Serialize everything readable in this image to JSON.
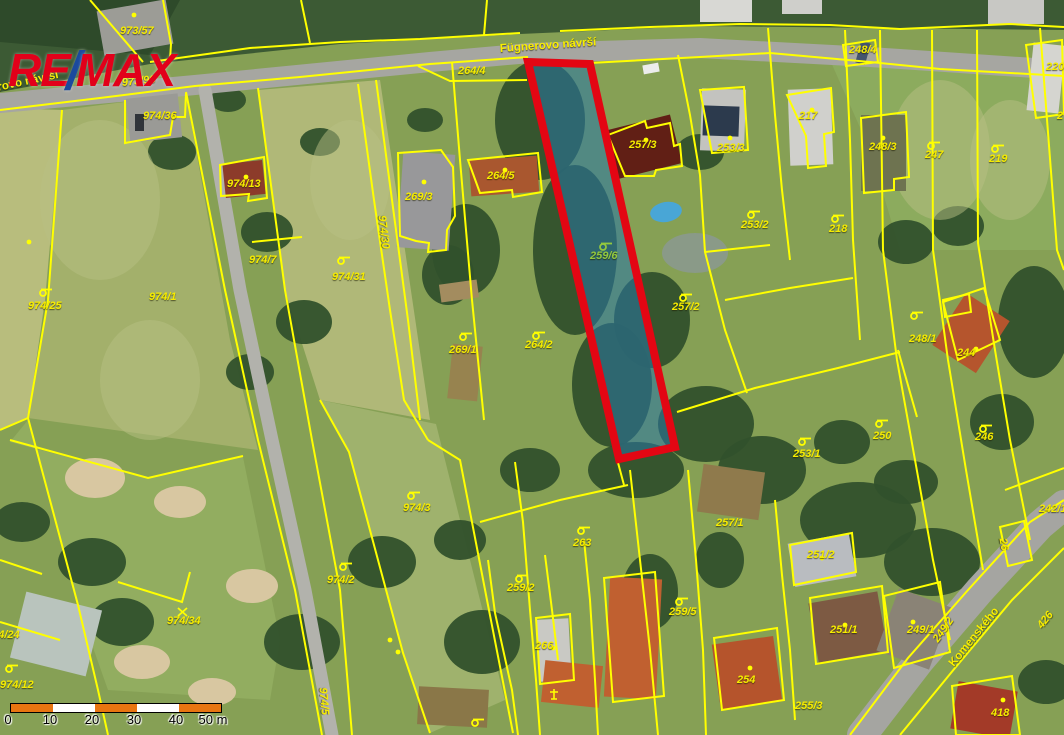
{
  "logo": {
    "re": "RE",
    "slash": "/",
    "max": "MAX",
    "red": "#e2001a",
    "blue": "#1b4a9e"
  },
  "highlight": {
    "label": "259/6",
    "points": "528,62 590,64 675,447 619,459",
    "fill": "#2877a8",
    "fill_opacity": 0.55,
    "stroke": "#e30613",
    "stroke_width": 8
  },
  "street_labels": [
    {
      "t": "Fügnerovo návrší",
      "x": -36,
      "y": 90,
      "r": -12
    },
    {
      "t": "Fügnerovo návrší",
      "x": 500,
      "y": 44,
      "r": -4
    },
    {
      "t": "Komenského",
      "x": 952,
      "y": 660,
      "r": -51
    }
  ],
  "parcel_labels": [
    {
      "t": "973/57",
      "x": 120,
      "y": 26
    },
    {
      "t": "973/96",
      "x": 122,
      "y": 78,
      "r": -6
    },
    {
      "t": "264/4",
      "x": 458,
      "y": 66
    },
    {
      "t": "974/36",
      "x": 143,
      "y": 111
    },
    {
      "t": "974/13",
      "x": 227,
      "y": 179
    },
    {
      "t": "974/7",
      "x": 249,
      "y": 255
    },
    {
      "t": "974/25",
      "x": 28,
      "y": 301
    },
    {
      "t": "974/1",
      "x": 149,
      "y": 292
    },
    {
      "t": "974/31",
      "x": 332,
      "y": 272
    },
    {
      "t": "974/30",
      "x": 381,
      "y": 210,
      "r": 83
    },
    {
      "t": "269/3",
      "x": 405,
      "y": 192
    },
    {
      "t": "264/5",
      "x": 487,
      "y": 171
    },
    {
      "t": "269/1",
      "x": 449,
      "y": 345
    },
    {
      "t": "264/2",
      "x": 525,
      "y": 340
    },
    {
      "t": "259/6",
      "x": 590,
      "y": 251,
      "c": "#93c83e"
    },
    {
      "t": "257/2",
      "x": 672,
      "y": 302
    },
    {
      "t": "257/3",
      "x": 629,
      "y": 140
    },
    {
      "t": "253/3",
      "x": 717,
      "y": 143
    },
    {
      "t": "217",
      "x": 799,
      "y": 111
    },
    {
      "t": "253/2",
      "x": 741,
      "y": 220
    },
    {
      "t": "218",
      "x": 829,
      "y": 224
    },
    {
      "t": "248/4",
      "x": 849,
      "y": 45
    },
    {
      "t": "248/3",
      "x": 869,
      "y": 142
    },
    {
      "t": "247",
      "x": 925,
      "y": 150
    },
    {
      "t": "219",
      "x": 989,
      "y": 154
    },
    {
      "t": "220",
      "x": 1046,
      "y": 62
    },
    {
      "t": "2",
      "x": 1057,
      "y": 111
    },
    {
      "t": "248/1",
      "x": 909,
      "y": 334
    },
    {
      "t": "244",
      "x": 957,
      "y": 348
    },
    {
      "t": "250",
      "x": 873,
      "y": 431
    },
    {
      "t": "246",
      "x": 975,
      "y": 432
    },
    {
      "t": "253/1",
      "x": 793,
      "y": 449
    },
    {
      "t": "974/3",
      "x": 403,
      "y": 503
    },
    {
      "t": "974/2",
      "x": 327,
      "y": 575
    },
    {
      "t": "263",
      "x": 573,
      "y": 538
    },
    {
      "t": "259/2",
      "x": 507,
      "y": 583
    },
    {
      "t": "266",
      "x": 535,
      "y": 641
    },
    {
      "t": "259/5",
      "x": 669,
      "y": 607
    },
    {
      "t": "257/1",
      "x": 716,
      "y": 518
    },
    {
      "t": "251/2",
      "x": 807,
      "y": 550
    },
    {
      "t": "251/1",
      "x": 830,
      "y": 625
    },
    {
      "t": "254",
      "x": 737,
      "y": 675
    },
    {
      "t": "255/3",
      "x": 795,
      "y": 701
    },
    {
      "t": "242/1",
      "x": 1039,
      "y": 504
    },
    {
      "t": "249/1",
      "x": 907,
      "y": 625
    },
    {
      "t": "249/2",
      "x": 936,
      "y": 636,
      "r": -55
    },
    {
      "t": "426",
      "x": 1040,
      "y": 622,
      "r": -51
    },
    {
      "t": "418",
      "x": 991,
      "y": 708
    },
    {
      "t": "974/34",
      "x": 167,
      "y": 616
    },
    {
      "t": "974/12",
      "x": 0,
      "y": 680
    },
    {
      "t": "974/24",
      "x": -14,
      "y": 630
    },
    {
      "t": "974/5",
      "x": 322,
      "y": 682,
      "r": 85
    },
    {
      "t": "26",
      "x": 1002,
      "y": 533,
      "r": 80
    }
  ],
  "symbols": [
    {
      "x": 38,
      "y": 286
    },
    {
      "x": 336,
      "y": 254
    },
    {
      "x": 458,
      "y": 330
    },
    {
      "x": 531,
      "y": 329
    },
    {
      "x": 598,
      "y": 240,
      "c": "#93c83e"
    },
    {
      "x": 678,
      "y": 291
    },
    {
      "x": 746,
      "y": 208
    },
    {
      "x": 830,
      "y": 212
    },
    {
      "x": 926,
      "y": 139
    },
    {
      "x": 990,
      "y": 142
    },
    {
      "x": 909,
      "y": 309
    },
    {
      "x": 874,
      "y": 417
    },
    {
      "x": 978,
      "y": 422
    },
    {
      "x": 797,
      "y": 435
    },
    {
      "x": 406,
      "y": 489
    },
    {
      "x": 338,
      "y": 560
    },
    {
      "x": 576,
      "y": 524
    },
    {
      "x": 514,
      "y": 572
    },
    {
      "x": 674,
      "y": 595
    },
    {
      "x": 4,
      "y": 662
    },
    {
      "x": 470,
      "y": 716
    },
    {
      "x": 176,
      "y": 606,
      "type": "x"
    },
    {
      "x": 548,
      "y": 688,
      "type": "cross"
    }
  ],
  "dots": [
    [
      134,
      15
    ],
    [
      246,
      177
    ],
    [
      424,
      182
    ],
    [
      505,
      170
    ],
    [
      646,
      140
    ],
    [
      730,
      138
    ],
    [
      812,
      110
    ],
    [
      883,
      138
    ],
    [
      976,
      349
    ],
    [
      822,
      558
    ],
    [
      845,
      625
    ],
    [
      750,
      668
    ],
    [
      553,
      648
    ],
    [
      913,
      622
    ],
    [
      1003,
      700
    ],
    [
      29,
      242
    ],
    [
      390,
      640
    ],
    [
      398,
      652
    ]
  ],
  "map": {
    "line_color": "#ffff00",
    "terrain_polys": [
      {
        "p": "0,0 1064,0 1064,30 700,26 520,34 340,44 150,64 0,92",
        "f": "#3c5a34"
      },
      {
        "p": "0,0 180,0 150,55 0,42",
        "f": "#2e4a2a"
      },
      {
        "p": "0,108 62,110 45,300 28,418 0,430",
        "f": "#b8bd7d"
      },
      {
        "p": "62,110 186,94 230,340 258,450 28,418 48,300",
        "f": "#a3b06b"
      },
      {
        "p": "258,90 380,80 430,420 320,400 285,290",
        "f": "#b0b878"
      },
      {
        "p": "320,400 436,424 470,560 505,700 430,733 403,653 349,452",
        "f": "#9fb26d"
      },
      {
        "p": "10,442 148,478 243,457 280,640 270,700 108,690 78,605 28,420",
        "f": "#92ad60"
      },
      {
        "p": "830,60 1064,80 1064,250 900,250 870,150",
        "f": "#8cab5e"
      }
    ],
    "trees": [
      [
        540,
        120,
        45,
        60
      ],
      [
        575,
        250,
        42,
        85
      ],
      [
        612,
        385,
        40,
        62
      ],
      [
        466,
        250,
        34,
        46
      ],
      [
        448,
        275,
        26,
        30
      ],
      [
        652,
        320,
        38,
        48
      ],
      [
        706,
        424,
        48,
        38
      ],
      [
        762,
        470,
        44,
        34
      ],
      [
        636,
        470,
        48,
        28
      ],
      [
        858,
        520,
        58,
        38
      ],
      [
        932,
        562,
        48,
        34
      ],
      [
        302,
        642,
        38,
        28
      ],
      [
        382,
        562,
        34,
        26
      ],
      [
        482,
        642,
        38,
        32
      ],
      [
        172,
        152,
        24,
        18
      ],
      [
        267,
        232,
        26,
        20
      ],
      [
        304,
        322,
        28,
        22
      ],
      [
        92,
        562,
        34,
        24
      ],
      [
        22,
        522,
        28,
        20
      ],
      [
        122,
        622,
        32,
        24
      ],
      [
        250,
        372,
        24,
        18
      ],
      [
        700,
        152,
        24,
        18
      ],
      [
        906,
        242,
        28,
        22
      ],
      [
        958,
        226,
        26,
        20
      ],
      [
        1034,
        322,
        36,
        56
      ],
      [
        1002,
        422,
        32,
        28
      ],
      [
        842,
        442,
        28,
        22
      ],
      [
        650,
        592,
        28,
        38
      ],
      [
        720,
        560,
        24,
        28
      ],
      [
        906,
        482,
        32,
        22
      ],
      [
        1046,
        682,
        28,
        22
      ],
      [
        320,
        142,
        20,
        14
      ],
      [
        228,
        100,
        18,
        12
      ],
      [
        425,
        120,
        18,
        12
      ],
      [
        530,
        470,
        30,
        22
      ],
      [
        460,
        540,
        26,
        20
      ]
    ],
    "light_patches": [
      [
        100,
        200,
        60,
        80
      ],
      [
        150,
        380,
        50,
        60
      ],
      [
        350,
        180,
        40,
        60
      ],
      [
        940,
        150,
        50,
        70
      ],
      [
        1010,
        160,
        40,
        60
      ]
    ],
    "sand": [
      [
        95,
        478,
        30,
        20
      ],
      [
        180,
        502,
        26,
        16
      ],
      [
        62,
        640,
        24,
        15
      ],
      [
        142,
        662,
        28,
        17
      ],
      [
        252,
        586,
        26,
        17
      ],
      [
        212,
        692,
        24,
        14
      ]
    ],
    "gray_patches": [
      [
        695,
        253,
        33,
        20
      ]
    ],
    "roads": [
      {
        "p": "0,103 195,85 430,62 530,53 700,48 870,57 1064,70",
        "w": 20,
        "f": "#a6a6a1"
      },
      {
        "p": "205,90 240,290 272,440 305,590 332,735",
        "w": 13,
        "f": "#b2b2ac"
      },
      {
        "p": "862,735 920,660 980,590 1040,525 1064,505",
        "w": 30,
        "f": "#a5a5a1"
      }
    ],
    "buildings": [
      [
        224,
        162,
        40,
        34,
        -6,
        "#8c3b2a"
      ],
      [
        400,
        153,
        52,
        96,
        4,
        "#98989a"
      ],
      [
        470,
        158,
        68,
        36,
        -4,
        "#a9572f"
      ],
      [
        609,
        122,
        68,
        50,
        -14,
        "#611f15"
      ],
      [
        701,
        89,
        44,
        62,
        2,
        "#c3c3bf"
      ],
      [
        703,
        106,
        36,
        30,
        2,
        "#2c3a4d"
      ],
      [
        789,
        89,
        43,
        76,
        -2,
        "#d0d0cc"
      ],
      [
        861,
        115,
        45,
        76,
        0,
        "#6e7350"
      ],
      [
        945,
        302,
        52,
        62,
        33,
        "#b5552d"
      ],
      [
        791,
        538,
        62,
        44,
        -10,
        "#b9bcc0"
      ],
      [
        813,
        597,
        70,
        60,
        -10,
        "#7d5a43"
      ],
      [
        716,
        640,
        62,
        66,
        -8,
        "#b5542c"
      ],
      [
        538,
        619,
        32,
        62,
        -3,
        "#c9c9c4"
      ],
      [
        607,
        578,
        52,
        120,
        3,
        "#c06030"
      ],
      [
        543,
        663,
        58,
        42,
        6,
        "#c06030"
      ],
      [
        886,
        596,
        56,
        66,
        20,
        "#8a8376"
      ],
      [
        954,
        686,
        60,
        48,
        10,
        "#a33a28"
      ],
      [
        17,
        600,
        78,
        68,
        14,
        "#b9c4bd"
      ],
      [
        100,
        5,
        70,
        45,
        -10,
        "#9c9c96"
      ],
      [
        128,
        96,
        52,
        44,
        -6,
        "#9a9a96"
      ],
      [
        1030,
        44,
        32,
        68,
        6,
        "#d5d5d0"
      ],
      [
        700,
        0,
        52,
        22,
        0,
        "#d8d8d4"
      ],
      [
        782,
        0,
        40,
        14,
        0,
        "#cfcfcb"
      ],
      [
        988,
        0,
        56,
        24,
        0,
        "#c8c8c4"
      ],
      [
        135,
        114,
        9,
        17,
        0,
        "#30343a"
      ],
      [
        858,
        42,
        10,
        22,
        15,
        "#44546e"
      ],
      [
        643,
        64,
        16,
        9,
        -10,
        "#ececec"
      ],
      [
        440,
        282,
        38,
        18,
        -8,
        "#a38c5f"
      ],
      [
        450,
        345,
        30,
        55,
        6,
        "#97834f"
      ],
      [
        700,
        468,
        62,
        48,
        8,
        "#8f7a4c"
      ],
      [
        418,
        688,
        70,
        38,
        3,
        "#8a7748"
      ]
    ],
    "pools": [
      {
        "cx": 666,
        "cy": 212,
        "rx": 16,
        "ry": 10,
        "f": "#49a6d6",
        "rot": -10
      }
    ],
    "lines": [
      "0,110 100,98 195,86 300,77 430,64 528,57",
      "590,63 700,57 770,53 870,62 940,69 1064,76",
      "150,62 250,48 340,42 420,39 520,33",
      "560,31 650,27 740,24 830,25 900,29 1010,24 1064,27",
      "90,0 143,62",
      "163,0 171,44 170,60",
      "310,43 301,0",
      "484,35 487,0",
      "125,100 125,143 170,135 173,117 185,117 186,93",
      "186,92 225,290 258,440 295,590 322,735",
      "258,88 285,290 312,440 340,590 352,735",
      "62,110 48,300 28,418",
      "28,418 0,430",
      "28,418 78,605 98,690 108,735",
      "10,440 148,478 243,456",
      "0,560 42,574",
      "0,622 60,640",
      "118,582 182,602 190,572",
      "252,242 302,237",
      "358,84 374,200 390,310 404,400 428,440",
      "376,80 392,200 408,320 420,420",
      "428,440 460,460 487,600 513,733",
      "320,400 349,452 403,653 430,733",
      "452,62 460,160 472,300 484,420",
      "418,66 450,81 527,80",
      "678,55 690,115 700,175 705,252 725,330 747,393",
      "677,412 755,388 838,368 900,352",
      "768,28 775,115 782,190 790,260",
      "705,252 770,245",
      "725,300 790,288 853,278",
      "845,30 850,140 853,240 860,340",
      "880,30 883,250 897,360 915,460 933,560 950,640",
      "932,30 933,250 948,360 966,470 983,570",
      "977,30 978,243 995,350 1010,440 1030,540",
      "1040,28 1057,250 1064,270",
      "898,350 917,417",
      "630,470 640,560 650,650 658,735",
      "688,470 696,560 703,650 706,735",
      "775,500 782,575 790,650 795,720",
      "515,462 523,522 530,610 536,680 540,735",
      "480,522 560,500 628,485",
      "617,459 624,485",
      "488,560 495,613 512,690 518,735",
      "545,555 552,610 558,660",
      "584,540 590,600 595,680 598,735",
      "850,735 908,658 968,590 1030,522 1064,500",
      "900,735 955,668 1012,600 1064,548",
      "1005,490 1064,468"
    ],
    "closed": [
      "220,165 264,157 267,198 248,201 249,194 221,196",
      "398,153 441,150 453,167 455,216 447,230 446,250 428,252 429,243 416,241 400,236",
      "468,160 538,153 542,192 513,197 512,190 480,193",
      "608,135 645,121 647,128 670,123 674,146 680,144 682,166 656,170 654,176 625,176",
      "700,90 744,87 748,150 712,153",
      "787,95 831,88 834,132 824,134 826,166 808,168 806,136",
      "861,118 906,112 909,177 894,179 894,190 864,193",
      "843,45 875,40 878,62 846,66",
      "943,302 984,288 1000,340 958,360",
      "943,300 969,294 971,312 945,317",
      "790,545 852,533 856,572 794,585",
      "810,598 882,586 888,652 816,664",
      "714,638 777,628 784,700 722,710",
      "536,618 570,614 574,680 540,684",
      "884,596 940,582 950,652 894,668",
      "952,686 1012,676 1020,735 956,735",
      "1026,45 1062,40 1064,114 1036,118",
      "1000,527 1024,521 1032,560 1008,566",
      "604,578 655,572 664,696 613,702"
    ]
  },
  "scale_bar": {
    "labels": [
      "0",
      "10",
      "20",
      "30",
      "40",
      "50 m"
    ],
    "label_xs": [
      8,
      50,
      92,
      134,
      176,
      213
    ],
    "colors": [
      "#e87511",
      "#ffffff",
      "#e87511",
      "#ffffff",
      "#e87511"
    ],
    "seg_w": 42
  }
}
